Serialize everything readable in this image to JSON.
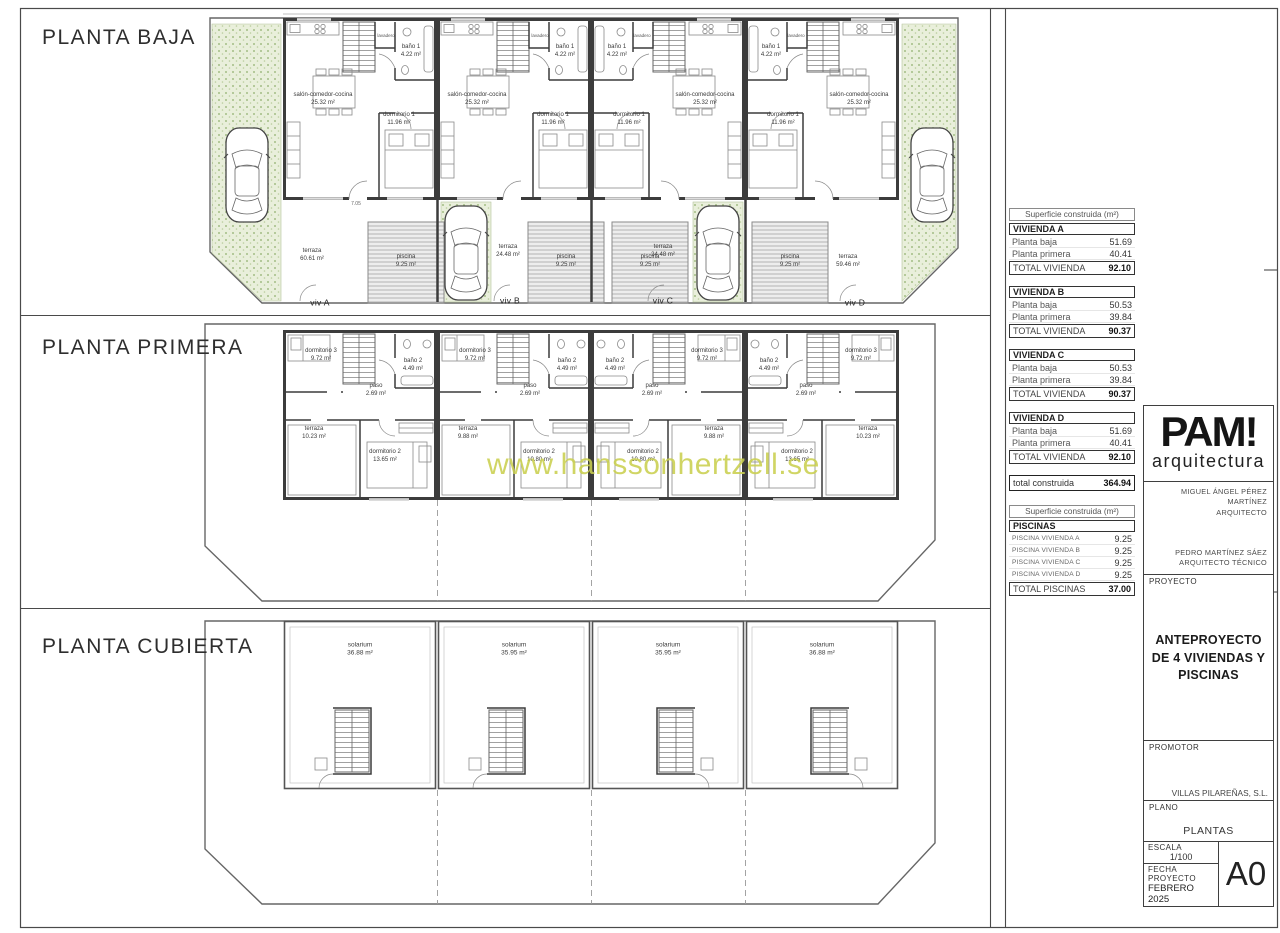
{
  "sheet": {
    "watermark": "www.hanssonhertzell.se",
    "sections": [
      {
        "title": "PLANTA BAJA"
      },
      {
        "title": "PLANTA PRIMERA"
      },
      {
        "title": "PLANTA CUBIERTA"
      }
    ]
  },
  "plans": {
    "baja": {
      "dim_terraza": "7.05",
      "rooms": {
        "salon": "salón-comedor-cocina",
        "salon_area": "25.32 m²",
        "lavadero": "lavadero",
        "bano": "baño 1",
        "bano_area": "4.22 m²",
        "dormitorio": "dormitorio 1",
        "dormitorio_area": "11.96 m²",
        "piscina": "piscina",
        "piscina_area": "9.25 m²",
        "terraza": "terraza"
      },
      "units": [
        {
          "viv": "viv A",
          "terraza_area": "60.61 m²"
        },
        {
          "viv": "viv B",
          "terraza_area": "24.48 m²"
        },
        {
          "viv": "viv C",
          "terraza_area": "24.48 m²"
        },
        {
          "viv": "viv D",
          "terraza_area": "59.46 m²"
        }
      ]
    },
    "primera": {
      "rooms": {
        "dormitorio3": "dormitorio 3",
        "dormitorio3_area": "9.72 m²",
        "bano2": "baño 2",
        "bano2_area": "4.49 m²",
        "paso": "paso",
        "paso_area": "2.69 m²",
        "terraza": "terraza",
        "dormitorio2": "dormitorio 2"
      },
      "units": [
        {
          "terraza_area": "10.23 m²",
          "dormitorio2_area": "13.65 m²"
        },
        {
          "terraza_area": "9.88 m²",
          "dormitorio2_area": "10.80 m²"
        },
        {
          "terraza_area": "9.88 m²",
          "dormitorio2_area": "10.80 m²"
        },
        {
          "terraza_area": "10.23 m²",
          "dormitorio2_area": "13.65 m²"
        }
      ]
    },
    "cubierta": {
      "rooms": {
        "solarium": "solarium"
      },
      "units": [
        {
          "area": "36.88 m²"
        },
        {
          "area": "35.95 m²"
        },
        {
          "area": "35.95 m²"
        },
        {
          "area": "36.88 m²"
        }
      ]
    }
  },
  "tables": {
    "surface_header": "Superficie construida (m²)",
    "viviendas": [
      {
        "name": "VIVIENDA A",
        "rows": [
          {
            "label": "Planta baja",
            "value": "51.69"
          },
          {
            "label": "Planta primera",
            "value": "40.41"
          }
        ],
        "total_label": "TOTAL VIVIENDA",
        "total": "92.10"
      },
      {
        "name": "VIVIENDA B",
        "rows": [
          {
            "label": "Planta baja",
            "value": "50.53"
          },
          {
            "label": "Planta primera",
            "value": "39.84"
          }
        ],
        "total_label": "TOTAL VIVIENDA",
        "total": "90.37"
      },
      {
        "name": "VIVIENDA C",
        "rows": [
          {
            "label": "Planta baja",
            "value": "50.53"
          },
          {
            "label": "Planta primera",
            "value": "39.84"
          }
        ],
        "total_label": "TOTAL VIVIENDA",
        "total": "90.37"
      },
      {
        "name": "VIVIENDA D",
        "rows": [
          {
            "label": "Planta baja",
            "value": "51.69"
          },
          {
            "label": "Planta primera",
            "value": "40.41"
          }
        ],
        "total_label": "TOTAL VIVIENDA",
        "total": "92.10"
      }
    ],
    "total_construida": {
      "label": "total construida",
      "value": "364.94"
    },
    "piscinas": {
      "header": "Superficie construida (m²)",
      "name": "PISCINAS",
      "rows": [
        {
          "label": "PISCINA VIVIENDA A",
          "value": "9.25"
        },
        {
          "label": "PISCINA VIVIENDA B",
          "value": "9.25"
        },
        {
          "label": "PISCINA VIVIENDA C",
          "value": "9.25"
        },
        {
          "label": "PISCINA VIVIENDA D",
          "value": "9.25"
        }
      ],
      "total_label": "TOTAL PISCINAS",
      "total": "37.00"
    }
  },
  "titleblock": {
    "logo": "PAM!",
    "logo_sub": "arquitectura",
    "architect_name": "MIGUEL ÁNGEL PÉREZ MARTÍNEZ",
    "architect_role": "ARQUITECTO",
    "technical_name": "PEDRO MARTÍNEZ SÁEZ",
    "technical_role": "ARQUITECTO TÉCNICO",
    "proyecto_label": "PROYECTO",
    "proyecto_value": "ANTEPROYECTO DE 4 VIVIENDAS Y PISCINAS",
    "promotor_label": "PROMOTOR",
    "promotor_value": "VILLAS PILAREÑAS, S.L.",
    "plano_label": "PLANO",
    "plano_value": "PLANTAS",
    "escala_label": "ESCALA",
    "escala_value": "1/100",
    "fecha_label": "FECHA PROYECTO",
    "fecha_value": "FEBRERO 2025",
    "sheet_size": "A0"
  }
}
